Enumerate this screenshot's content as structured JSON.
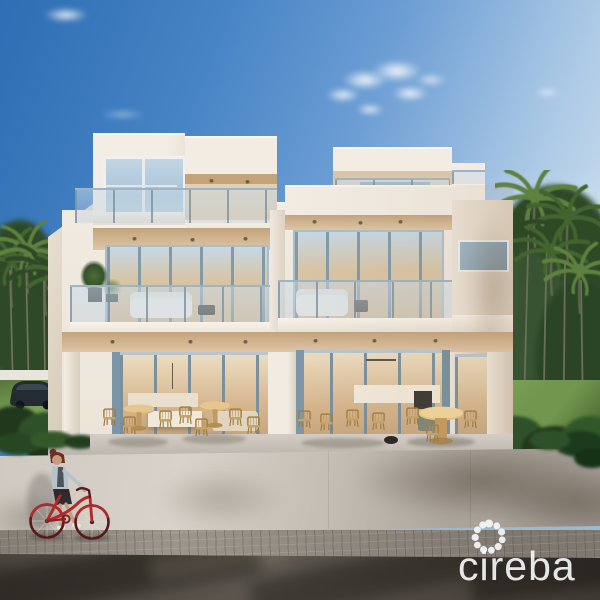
{
  "watermark": {
    "brand": "cireba",
    "icon": "cireba-dotted-flower-logo"
  },
  "scene": {
    "subject": "modern-white-duplex-villa-rendering",
    "setting": "tropical-palm-garden-under-blue-sky",
    "foreground": "street-wall-sidewalk-and-road",
    "objects": [
      "three-storey-house",
      "roof-terraces",
      "glass-balconies",
      "folding-glass-doors",
      "patio-dining-furniture",
      "balcony-plants",
      "palm-trees",
      "lawn",
      "parked-car",
      "woman-walking-red-bicycle",
      "street-wall",
      "paved-sidewalk",
      "asphalt-road"
    ]
  },
  "colors": {
    "skyTop": "#2f6db4",
    "skyMid": "#6d9ed4",
    "skyLow": "#cadded",
    "skyPale": "#e2ecf4",
    "facadeLit": "#f2ece3",
    "facadeShade": "#e4dacb",
    "facadeSide": "#dcd1c1",
    "soffit": "#dfc6a6",
    "soffitDeep": "#c3a37c",
    "interiorWarm": "#d5b58e",
    "interiorLight": "#ecdfc6",
    "frame": "#7e97a8",
    "frameLight": "#b9cad7",
    "glassSky": "#c6d8e4",
    "glassWarm": "#dcc09a",
    "railPost": "#8ca3b4",
    "palmDark": "#2e4827",
    "palmMid": "#43642f",
    "palmLight": "#5e8140",
    "grass": "#7aa153",
    "grassShade": "#48683a",
    "bushDark": "#22391f",
    "wallLit": "#d8d2ca",
    "wallShade": "#a29b92",
    "paver": "#9c958c",
    "road": "#56504a",
    "bikeRed": "#b02a2b",
    "hairAuburn": "#6d3026",
    "denim": "#b6c2cc",
    "skin": "#c79b7e",
    "skirtDark": "#2e2b33",
    "carDark": "#232c33",
    "logoWhite": "#f5f7f8"
  }
}
